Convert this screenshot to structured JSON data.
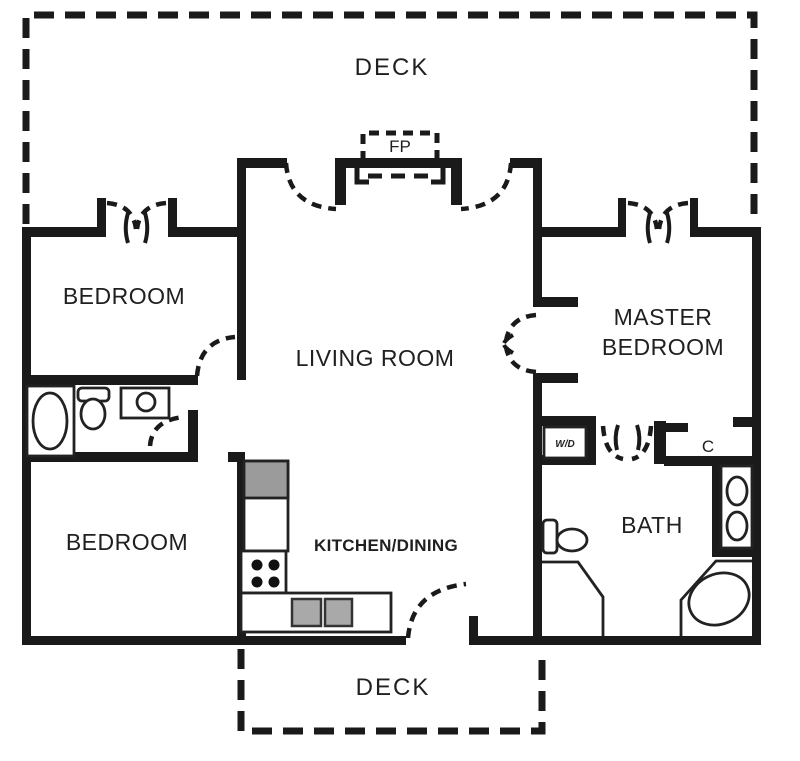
{
  "diagram_type": "residential-floor-plan",
  "colors": {
    "wall": "#1a1a1a",
    "background": "#ffffff",
    "appliance_gray": "#9b9b9b",
    "sink_gray": "#a9a9a9",
    "fixture_stroke": "#222222"
  },
  "labels": {
    "deck_top": "DECK",
    "deck_bottom": "DECK",
    "fp": "FP",
    "bedroom_top": "BEDROOM",
    "bedroom_bottom": "BEDROOM",
    "living_room": "LIVING ROOM",
    "master_line1": "MASTER",
    "master_line2": "BEDROOM",
    "kitchen": "KITCHEN/DINING",
    "bath": "BATH",
    "wd": "W/D",
    "closet": "C"
  },
  "rooms": [
    {
      "name": "Deck (top)"
    },
    {
      "name": "Living Room with fireplace"
    },
    {
      "name": "Bedroom (upper left)"
    },
    {
      "name": "Bathroom (left, tub/toilet/sink)"
    },
    {
      "name": "Bedroom (lower left)"
    },
    {
      "name": "Kitchen/Dining with L-shaped counter"
    },
    {
      "name": "Master Bedroom"
    },
    {
      "name": "Bath (right, shower/corner tub/double vanity)"
    },
    {
      "name": "W/D closet"
    },
    {
      "name": "Closet C"
    },
    {
      "name": "Deck (bottom)"
    }
  ]
}
